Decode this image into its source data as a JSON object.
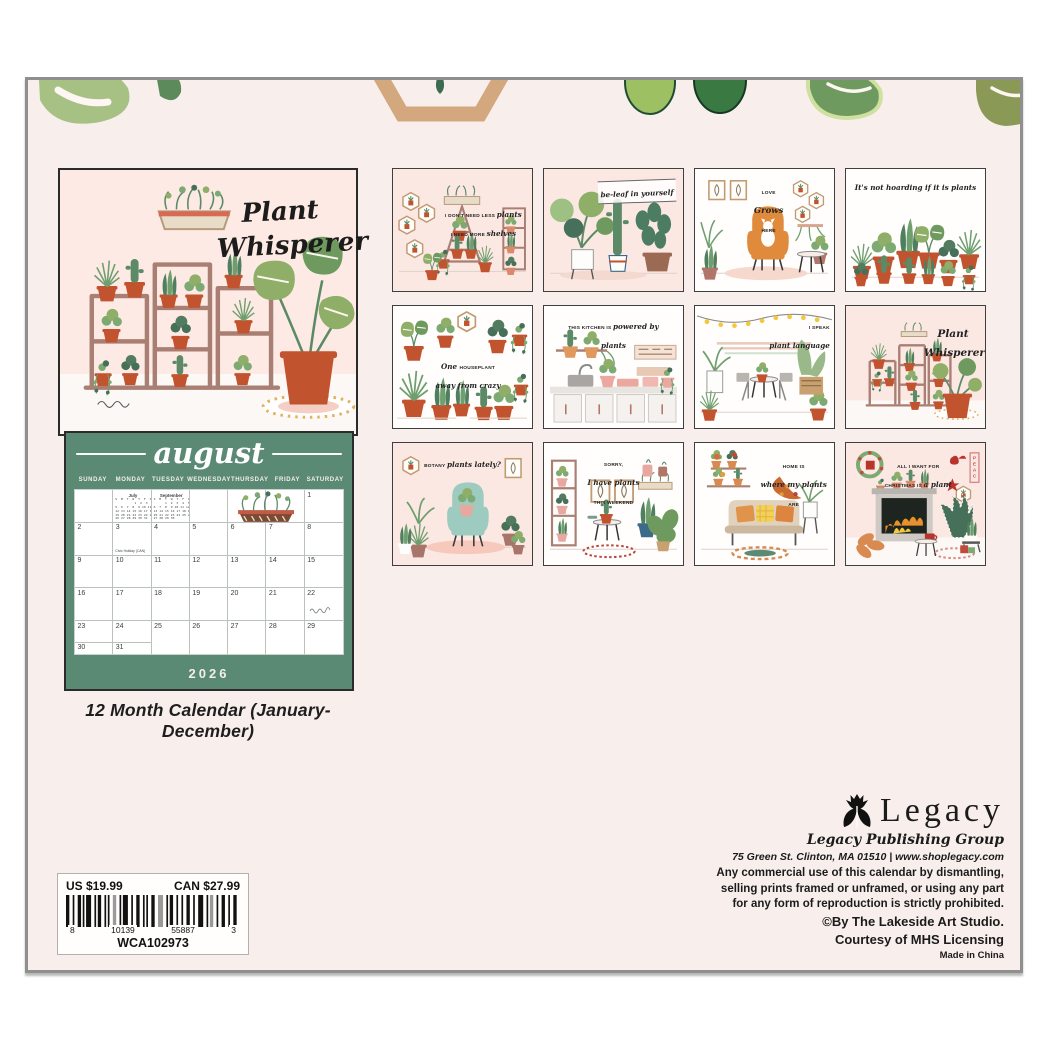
{
  "colors": {
    "panel_bg": "#f8efec",
    "cover_pink": "#fdeae5",
    "sage_green": "#5b8a74",
    "terracotta": "#c2532f",
    "leaf_green": "#8fae67",
    "dark_leaf": "#46705a",
    "wood": "#ab8277"
  },
  "cover": {
    "title_line1": "Plant",
    "title_line2": "Whisperer"
  },
  "product": {
    "caption": "12 Month Calendar (January-December)",
    "price_us": "US $19.99",
    "price_can": "CAN $27.99",
    "upc": {
      "left": "8",
      "mid1": "10139",
      "mid2": "55887",
      "right": "3"
    },
    "sku": "WCA102973"
  },
  "august": {
    "month_name": "august",
    "year": "2026",
    "day_headers": [
      "SUNDAY",
      "MONDAY",
      "TUESDAY",
      "WEDNESDAY",
      "THURSDAY",
      "FRIDAY",
      "SATURDAY"
    ],
    "holiday_note": "Civic Holiday (CAN)",
    "weeks": [
      [
        "",
        "",
        "",
        "",
        "",
        "",
        "1"
      ],
      [
        "2",
        "3",
        "4",
        "5",
        "6",
        "7",
        "8"
      ],
      [
        "9",
        "10",
        "11",
        "12",
        "13",
        "14",
        "15"
      ],
      [
        "16",
        "17",
        "18",
        "19",
        "20",
        "21",
        "22"
      ],
      [
        "23",
        "24",
        "25",
        "26",
        "27",
        "28",
        "29"
      ]
    ],
    "overflow_days": [
      "30",
      "31"
    ],
    "mini_months": [
      {
        "name": "July",
        "rows": [
          "S  M  T  W  T  F  S",
          "          1  2  3  4",
          "5  6  7  8  9 10 11",
          "12 13 14 15 16 17 18",
          "19 20 21 22 23 24 25",
          "26 27 28 29 30 31"
        ]
      },
      {
        "name": "September",
        "rows": [
          "S  M  T  W  T  F  S",
          "      1  2  3  4  5",
          "6  7  8  9 10 11 12",
          "13 14 15 16 17 18 19",
          "20 21 22 23 24 25 26",
          "27 28 29 30"
        ]
      }
    ]
  },
  "thumbnails": [
    {
      "bg": "pink",
      "lines": [
        [
          [
            "I DON'T NEED LESS ",
            0
          ],
          [
            "plants",
            1
          ]
        ],
        [
          [
            "I NEED MORE ",
            0
          ],
          [
            "shelves",
            1
          ]
        ]
      ]
    },
    {
      "bg": "pink",
      "lines": [
        [
          [
            "be-leaf in yourself",
            1
          ]
        ]
      ]
    },
    {
      "bg": "white",
      "lines": [
        [
          [
            "LOVE",
            0
          ]
        ],
        [
          [
            "Grows",
            1
          ]
        ],
        [
          [
            "HERE",
            0
          ]
        ]
      ]
    },
    {
      "bg": "white",
      "lines": [
        [
          [
            "It's not hoarding if it is plants",
            1
          ]
        ]
      ]
    },
    {
      "bg": "white",
      "lines": [
        [
          [
            "One ",
            1
          ],
          [
            "HOUSEPLANT",
            0
          ]
        ],
        [
          [
            "away from crazy",
            1
          ]
        ]
      ]
    },
    {
      "bg": "white",
      "lines": [
        [
          [
            "THIS KITCHEN IS ",
            0
          ],
          [
            "powered by plants",
            1
          ]
        ]
      ]
    },
    {
      "bg": "white",
      "lines": [
        [
          [
            "I SPEAK",
            0
          ]
        ],
        [
          [
            "plant language",
            1
          ]
        ]
      ]
    },
    {
      "bg": "pink",
      "lines": [
        [
          [
            "Plant",
            1
          ]
        ],
        [
          [
            "Whisperer",
            1
          ]
        ]
      ]
    },
    {
      "bg": "pink",
      "lines": [
        [
          [
            "BOTANY ",
            0
          ],
          [
            "plants lately?",
            1
          ]
        ]
      ]
    },
    {
      "bg": "white",
      "lines": [
        [
          [
            "SORRY,",
            0
          ]
        ],
        [
          [
            "I have plants",
            1
          ]
        ],
        [
          [
            "THIS WEEKEND",
            0
          ]
        ]
      ]
    },
    {
      "bg": "white",
      "lines": [
        [
          [
            "HOME IS",
            0
          ]
        ],
        [
          [
            "where my plants",
            1
          ]
        ],
        [
          [
            "ARE",
            0
          ]
        ]
      ]
    },
    {
      "bg": "pink",
      "lines": [
        [
          [
            "ALL I WANT FOR",
            0
          ]
        ],
        [
          [
            "CHRISTMAS IS ",
            0
          ],
          [
            "a plant",
            1
          ]
        ]
      ]
    }
  ],
  "publisher": {
    "brand": "Legacy",
    "group": "Legacy Publishing Group",
    "address": "75 Green St. Clinton, MA 01510 | www.shoplegacy.com",
    "legal_lines": [
      "Any commercial use of this calendar by dismantling,",
      "selling prints framed or unframed, or using any part",
      "for any form of reproduction is strictly prohibited."
    ],
    "copyright": "©By The Lakeside Art Studio.",
    "courtesy": "Courtesy of MHS Licensing",
    "made_in": "Made in China"
  }
}
